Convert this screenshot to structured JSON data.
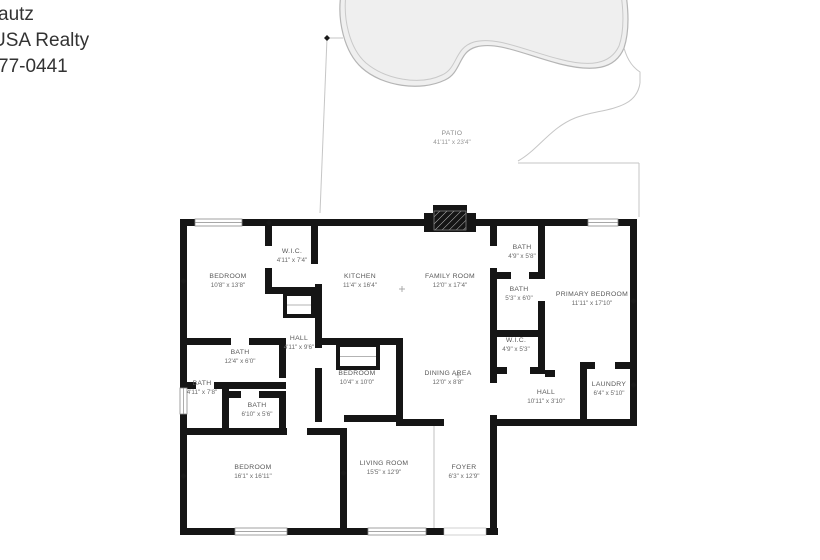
{
  "branding": {
    "line1": "autz",
    "line2": "USA Realty",
    "line3": "77-0441"
  },
  "floorplan": {
    "patio": {
      "name": "PATIO",
      "dims": "41'11\" x 23'4\""
    },
    "rooms": [
      {
        "id": "bedroom-1",
        "name": "BEDROOM",
        "dims": "10'8\" x 13'8\""
      },
      {
        "id": "wic-1",
        "name": "W.I.C.",
        "dims": "4'11\" x 7'4\""
      },
      {
        "id": "kitchen",
        "name": "KITCHEN",
        "dims": "11'4\" x 16'4\""
      },
      {
        "id": "family-room",
        "name": "FAMILY ROOM",
        "dims": "12'0\" x 17'4\""
      },
      {
        "id": "bath-1",
        "name": "BATH",
        "dims": "4'9\" x 5'8\""
      },
      {
        "id": "bath-2",
        "name": "BATH",
        "dims": "5'3\" x 6'0\""
      },
      {
        "id": "primary-bedroom",
        "name": "PRIMARY BEDROOM",
        "dims": "11'11\" x 17'10\""
      },
      {
        "id": "hall-1",
        "name": "HALL",
        "dims": "4'11\" x 9'6\""
      },
      {
        "id": "bath-3",
        "name": "BATH",
        "dims": "12'4\" x 6'0\""
      },
      {
        "id": "bath-4",
        "name": "BATH",
        "dims": "4'11\" x 7'8\""
      },
      {
        "id": "bath-5",
        "name": "BATH",
        "dims": "6'10\" x 5'6\""
      },
      {
        "id": "bedroom-2",
        "name": "BEDROOM",
        "dims": "10'4\" x 10'0\""
      },
      {
        "id": "dining-area",
        "name": "DINING AREA",
        "dims": "12'0\" x 8'8\""
      },
      {
        "id": "wic-2",
        "name": "W.I.C.",
        "dims": "4'9\" x 5'3\""
      },
      {
        "id": "hall-2",
        "name": "HALL",
        "dims": "10'11\" x 3'10\""
      },
      {
        "id": "laundry",
        "name": "LAUNDRY",
        "dims": "6'4\" x 5'10\""
      },
      {
        "id": "bedroom-3",
        "name": "BEDROOM",
        "dims": "16'1\" x 16'11\""
      },
      {
        "id": "living-room",
        "name": "LIVING ROOM",
        "dims": "15'5\" x 12'9\""
      },
      {
        "id": "foyer",
        "name": "FOYER",
        "dims": "6'3\" x 12'9\""
      }
    ]
  },
  "colors": {
    "background": "#ffffff",
    "wall": "#151515",
    "pool_fill": "#efefef",
    "pool_outline": "#b5b5b5",
    "patio_line": "#c6c6c6",
    "room_label": "#585858",
    "brand_text": "#333333"
  }
}
